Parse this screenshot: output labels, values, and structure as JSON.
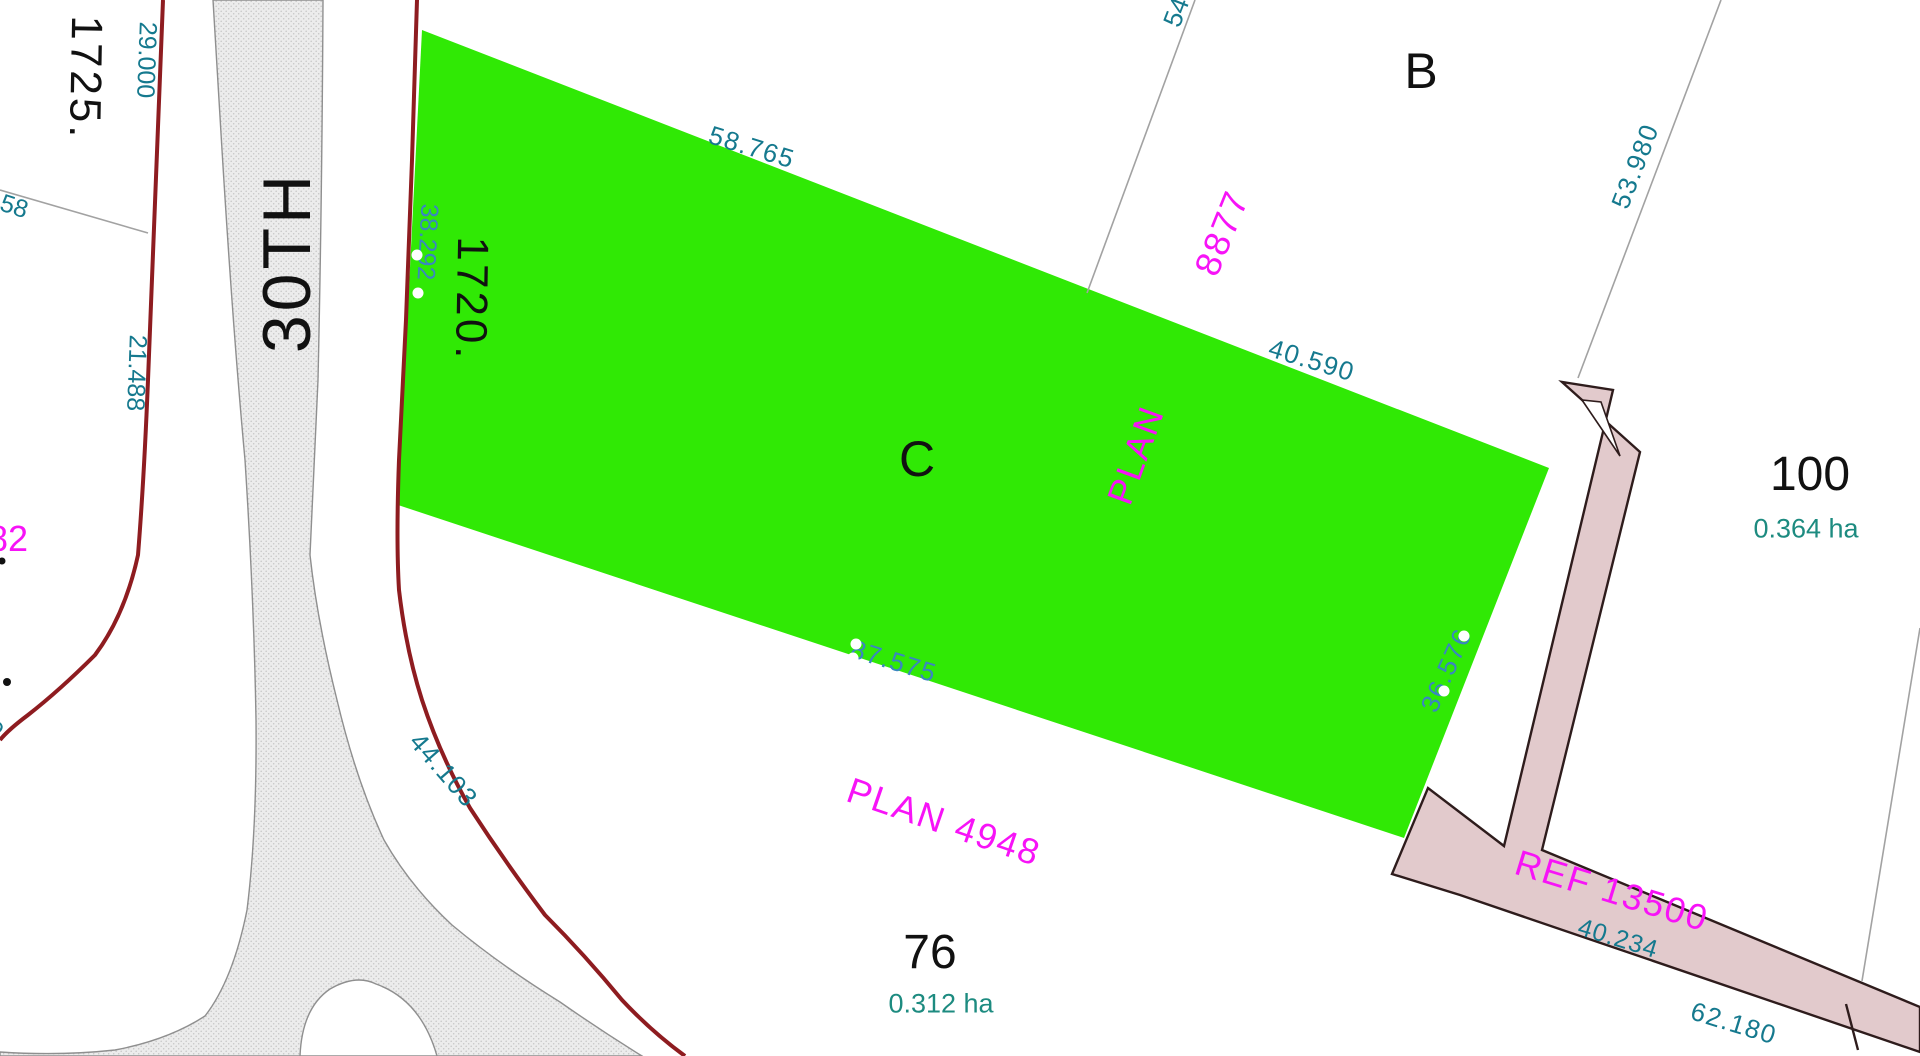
{
  "road": {
    "name": "30TH"
  },
  "parcels": {
    "p1725": {
      "label": "1725."
    },
    "p1720": {
      "label": "1720."
    },
    "pB": {
      "label": "B"
    },
    "pC": {
      "label": "C"
    },
    "p76": {
      "label": "76",
      "area": "0.312 ha"
    },
    "p100": {
      "label": "100",
      "area": "0.364 ha"
    },
    "p82_partial": {
      "label": "82"
    }
  },
  "plan_labels": {
    "plan_8877_word": "PLAN",
    "plan_8877_num": "8877",
    "plan_4948": "PLAN 4948",
    "ref_13500": "REF  13500"
  },
  "dimensions": {
    "d29000": "29.000",
    "d58_partial": "58",
    "d21488": "21.488",
    "d38292": "38.292",
    "d58765": "58.765",
    "d54_partial": "54",
    "d40590": "40.590",
    "d53980": "53.980",
    "d87575": "87.575",
    "d36576": "36.576",
    "d44103": "44.103",
    "d40234": "40.234",
    "d62180": "62.180",
    "d0_partial": "0"
  },
  "colors": {
    "highlight_green": "#30e905",
    "pink_fill": "#e2cacc",
    "pink_outline": "#2e1c1c",
    "road_fill": "#ececec",
    "road_stipple": "#c6c6c6",
    "road_outline": "#8f8f8f",
    "boundary_red": "#8e1c20",
    "parcel_line_gray": "#a2a2a2",
    "dim_teal": "#15798e",
    "dim_blue": "#3a86c0",
    "area_teal": "#1d8b80",
    "plan_magenta": "#f713f7"
  }
}
